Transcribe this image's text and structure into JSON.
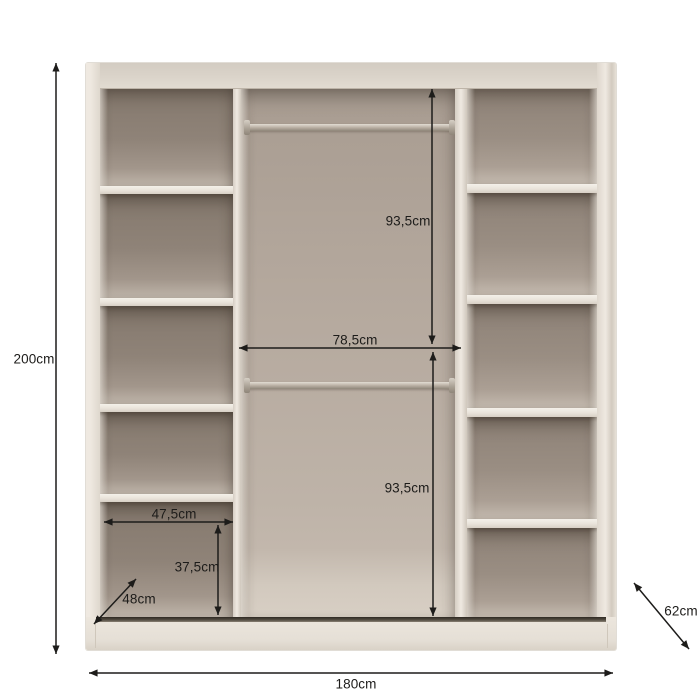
{
  "diagram": {
    "kind": "furniture-dimension-diagram",
    "item": "sliding-door wardrobe interior with shelf columns and hanging rails"
  },
  "labels": {
    "height": "200cm",
    "width": "180cm",
    "depth": "62cm",
    "upper_section_height": "93,5cm",
    "lower_section_height": "93,5cm",
    "center_section_width": "78,5cm",
    "shelf_width": "47,5cm",
    "bottom_compartment_height": "37,5cm",
    "shelf_depth": "48cm"
  },
  "structure": {
    "left_column_shelf_count": 4,
    "right_column_shelf_count": 4,
    "hanging_rail_count": 2
  },
  "colors": {
    "background": "#ffffff",
    "body_cream": "#e9e3da",
    "interior_taupe": "#8f8378",
    "interior_light": "#c4b9ae",
    "rail_metal": "#b2a99d",
    "track_dark": "#3a342d",
    "dimension_ink": "#1d1c1a"
  }
}
